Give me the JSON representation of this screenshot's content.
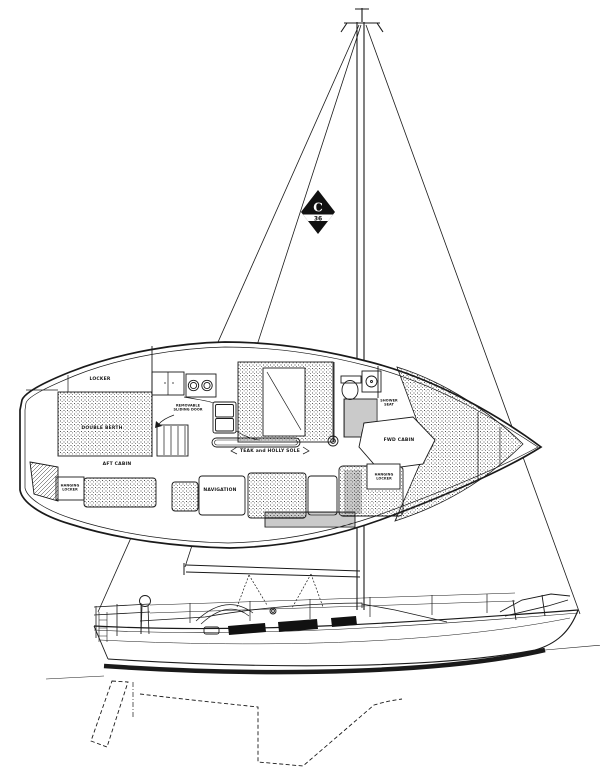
{
  "colors": {
    "ink": "#1a1a1a",
    "paper": "#ffffff"
  },
  "insignia": {
    "letter": "C",
    "number": "36"
  },
  "plan_labels": {
    "locker": "LOCKER",
    "double_berth": "DOUBLE BERTH",
    "aft_cabin": "AFT CABIN",
    "hanging_locker_aft": {
      "line1": "HANGING",
      "line2": "LOCKER"
    },
    "removable_door": {
      "line1": "REMOVABLE",
      "line2": "SLIDING DOOR"
    },
    "navigation": "NAVIGATION",
    "cabin_sole": "TEAK and HOLLY SOLE",
    "fwd_cabin": "FWD CABIN",
    "shower_seat": {
      "line1": "SHOWER",
      "line2": "SEAT"
    },
    "hanging_locker_fwd": {
      "line1": "HANGING",
      "line2": "LOCKER"
    }
  }
}
